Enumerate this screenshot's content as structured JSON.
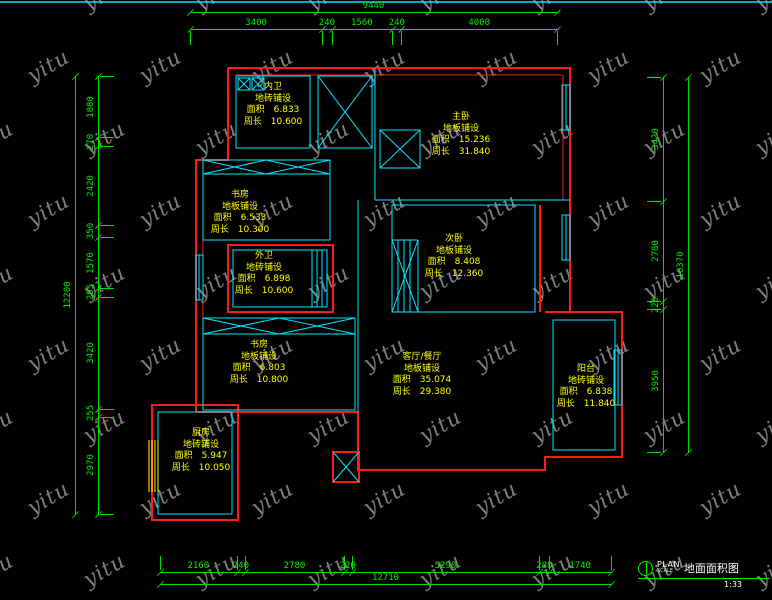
{
  "colors": {
    "background": "#000000",
    "outer_wall": "#ff1a1a",
    "partition_wall": "#00e5ff",
    "dimension": "#00e000",
    "room_text": "#ffff00",
    "window_frame": "#ffff00",
    "watermark": "#9b9b9b"
  },
  "watermark": {
    "text": "yitu"
  },
  "labels": {
    "area": "面积",
    "perimeter": "周长"
  },
  "dimensions": {
    "top": {
      "total": "9440",
      "segments": [
        "3400",
        "240",
        "1560",
        "240",
        "4000"
      ]
    },
    "bottom": {
      "total": "12710",
      "segments": [
        "2160",
        "240",
        "2780",
        "220",
        "5290",
        "280",
        "1740"
      ]
    },
    "left": {
      "total": "12200",
      "segments": [
        "1880",
        "270",
        "2420",
        "350",
        "1570",
        "255",
        "3420",
        "255",
        "2970"
      ]
    },
    "right": {
      "total": "10370",
      "segments": [
        "3420",
        "2780",
        "220",
        "3950"
      ]
    }
  },
  "rooms": [
    {
      "name": "内卫",
      "finish": "地砖铺设",
      "area": "6.833",
      "perimeter": "10.600"
    },
    {
      "name": "主卧",
      "finish": "地板铺设",
      "area": "15.236",
      "perimeter": "31.840"
    },
    {
      "name": "书房",
      "finish": "地板铺设",
      "area": "6.533",
      "perimeter": "10.300"
    },
    {
      "name": "次卧",
      "finish": "地板铺设",
      "area": "8.408",
      "perimeter": "12.360"
    },
    {
      "name": "外卫",
      "finish": "地砖铺设",
      "area": "6.898",
      "perimeter": "10.600"
    },
    {
      "name": "书房",
      "finish": "地板铺设",
      "area": "6.803",
      "perimeter": "10.800"
    },
    {
      "name": "客厅/餐厅",
      "finish": "地板铺设",
      "area": "35.074",
      "perimeter": "29.380"
    },
    {
      "name": "阳台",
      "finish": "地砖铺设",
      "area": "6.838",
      "perimeter": "11.840"
    },
    {
      "name": "厨房",
      "finish": "地砖铺设",
      "area": "5.947",
      "perimeter": "10.050"
    }
  ],
  "title_block": {
    "plan_label": "PLAN",
    "scale_label": "SCALE",
    "drawing_name": "地面面积图",
    "scale": "1:33"
  }
}
